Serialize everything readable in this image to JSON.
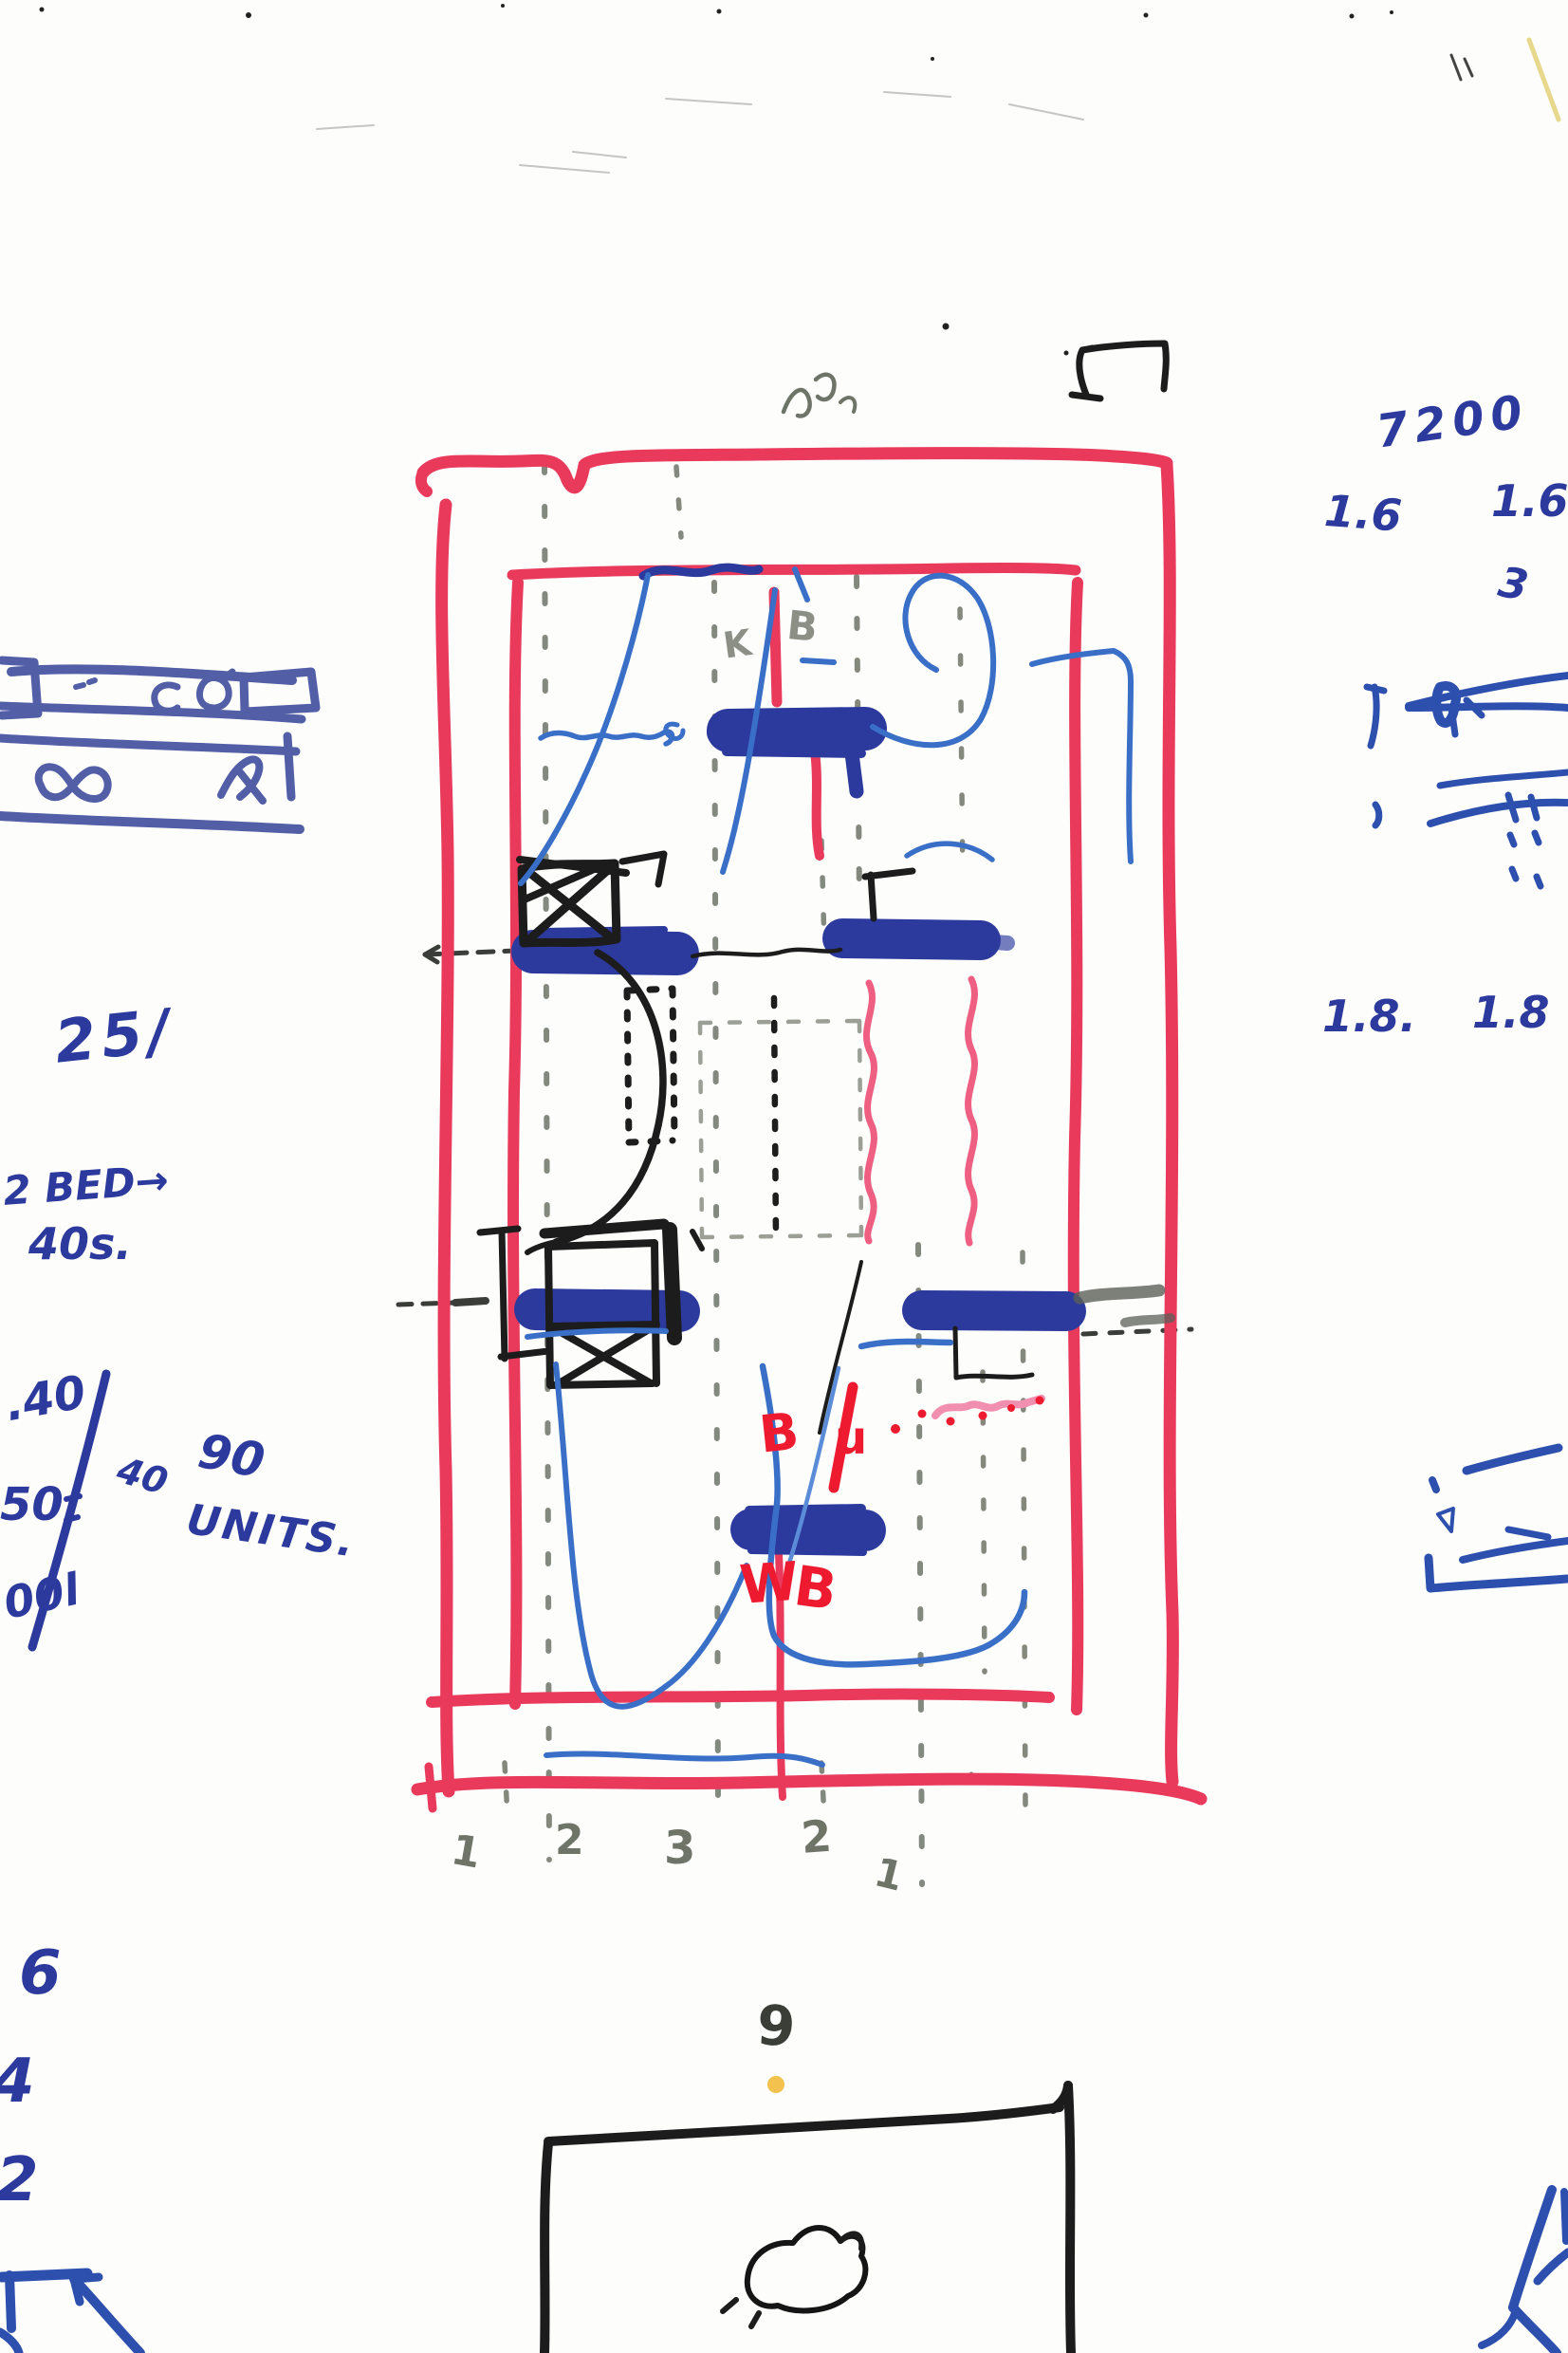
{
  "sketch": {
    "blue_notes": {
      "n7200": "7200",
      "n16_left": "1.6",
      "n16_right": "1.6",
      "n3": "3",
      "n18_left": "1.8.",
      "n18_right": "1.8",
      "n25": "25/",
      "n2bed": "2 BED→",
      "n40s": "40s.",
      "n_dot40": ".40",
      "n50": "50",
      "n00l": "00l",
      "n40_small": "40",
      "n90": "90",
      "n_units": "UNITS.",
      "n6": "6",
      "n4": "4",
      "n2": "2"
    },
    "pencil_notes": {
      "k": "K",
      "b": "B",
      "grid_1a": "1",
      "grid_2a": "2",
      "grid_3": "3",
      "grid_2b": "2",
      "grid_1b": "1",
      "n9": "9"
    },
    "red_notes": {
      "b_upper": "B",
      "u_upper": "u",
      "w_lower": "W",
      "b_lower": "B"
    },
    "colors": {
      "red_marker": "#e93a5c",
      "red_wavy": "#ef5f82",
      "navy_marker": "#2b3a9c",
      "pen_blue": "#3a6fc8",
      "crayon_blue": "#44519f",
      "right_pen_blue": "#2d4fae",
      "red_pen": "#ee1b30",
      "pink_scribble": "#f08fb0",
      "pencil": "#6f7468",
      "black_ink": "#1c1c1c",
      "yellow_dot": "#f2c14e",
      "paper_stain": "#efe7cc",
      "paper": "#fdfdfc"
    }
  }
}
